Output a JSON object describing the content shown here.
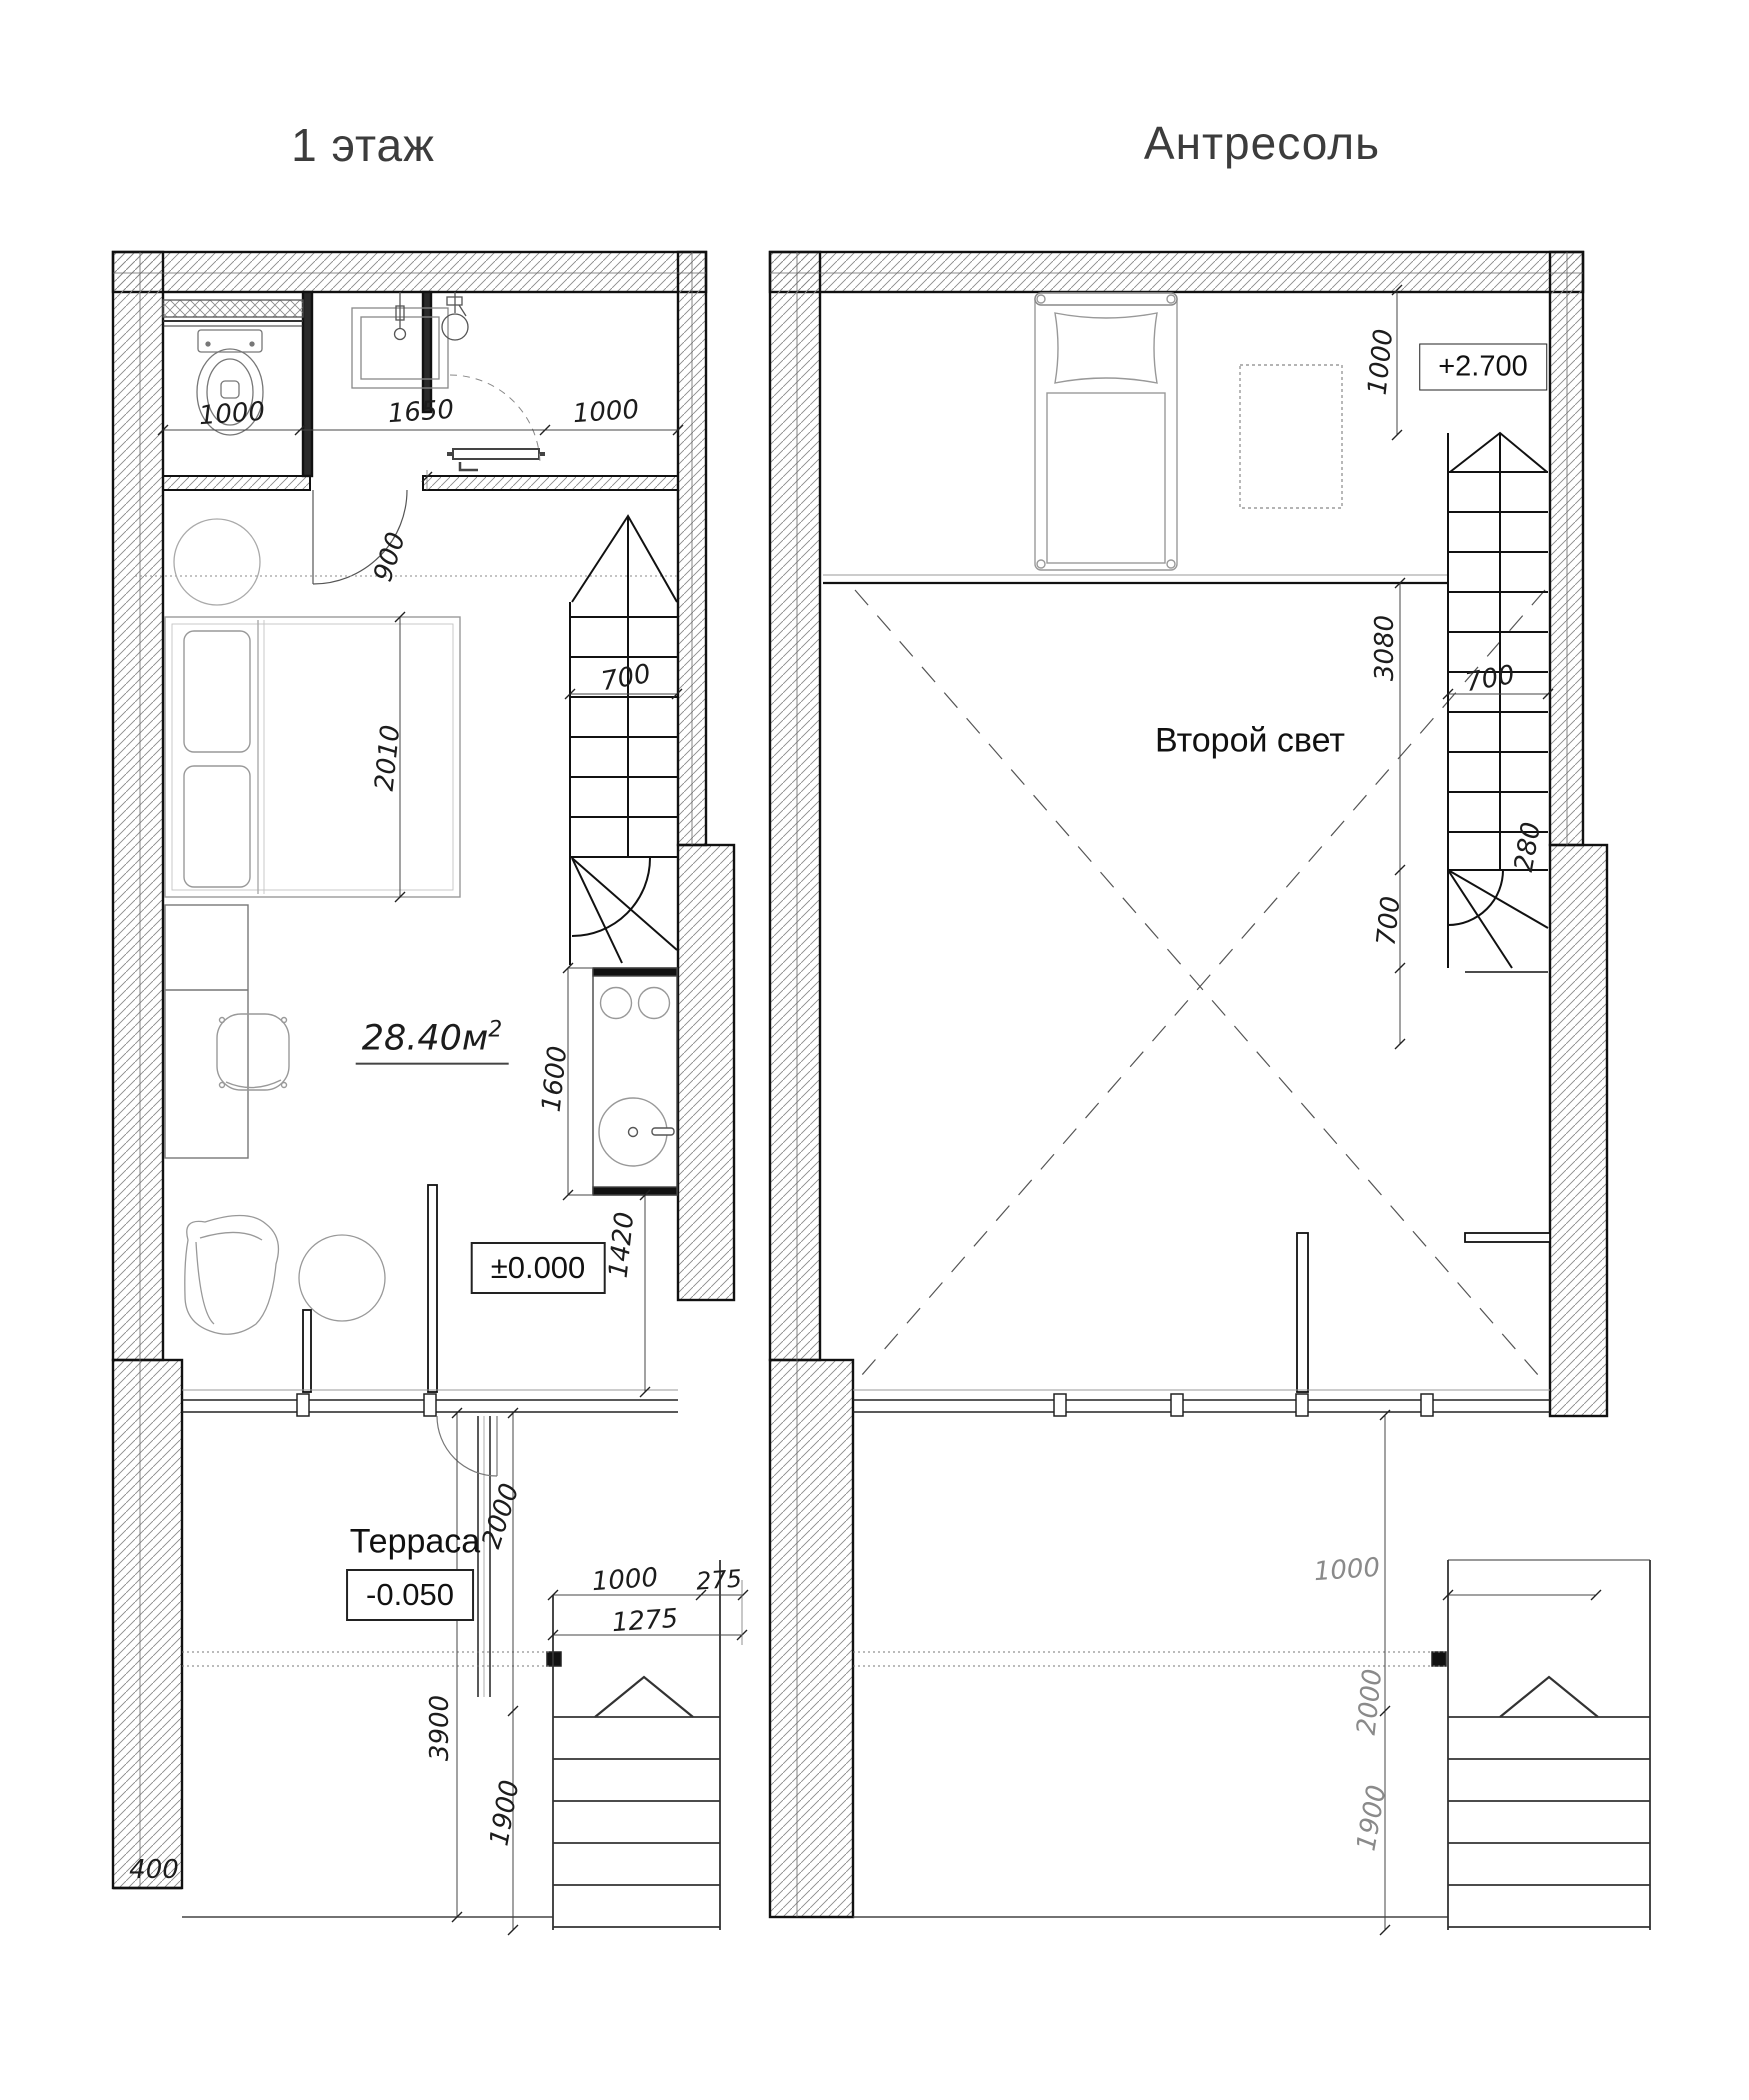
{
  "titles": {
    "left": "1 этаж",
    "right": "Антресоль"
  },
  "left_plan": {
    "area_value": "28.40м",
    "area_sup": "2",
    "terrace_label": "Терраса",
    "level_main": "±0.000",
    "level_terrace": "-0.050",
    "dims": {
      "bath_left": "1000",
      "bath_mid": "1650",
      "bath_right": "1000",
      "door": "900",
      "bed_length": "2010",
      "stair_width": "700",
      "kitchen_length": "1600",
      "kitchen_to_front": "1420",
      "terrace_door": "2000",
      "terrace_depth": "3900",
      "ext_stair_length": "1900",
      "ext_stair_width": "1000",
      "ext_stair_offset": "275",
      "ext_stair_total": "1275",
      "wall_offset": "400"
    }
  },
  "right_plan": {
    "void_label": "Второй свет",
    "level_mezzanine": "+2.700",
    "dims": {
      "bed_zone": "1000",
      "void_length": "3080",
      "stair_width": "700",
      "niche": "280",
      "winder": "700",
      "door_zone": "2000",
      "ext_stair_length": "1900",
      "ext_stair_width": "1000"
    }
  }
}
